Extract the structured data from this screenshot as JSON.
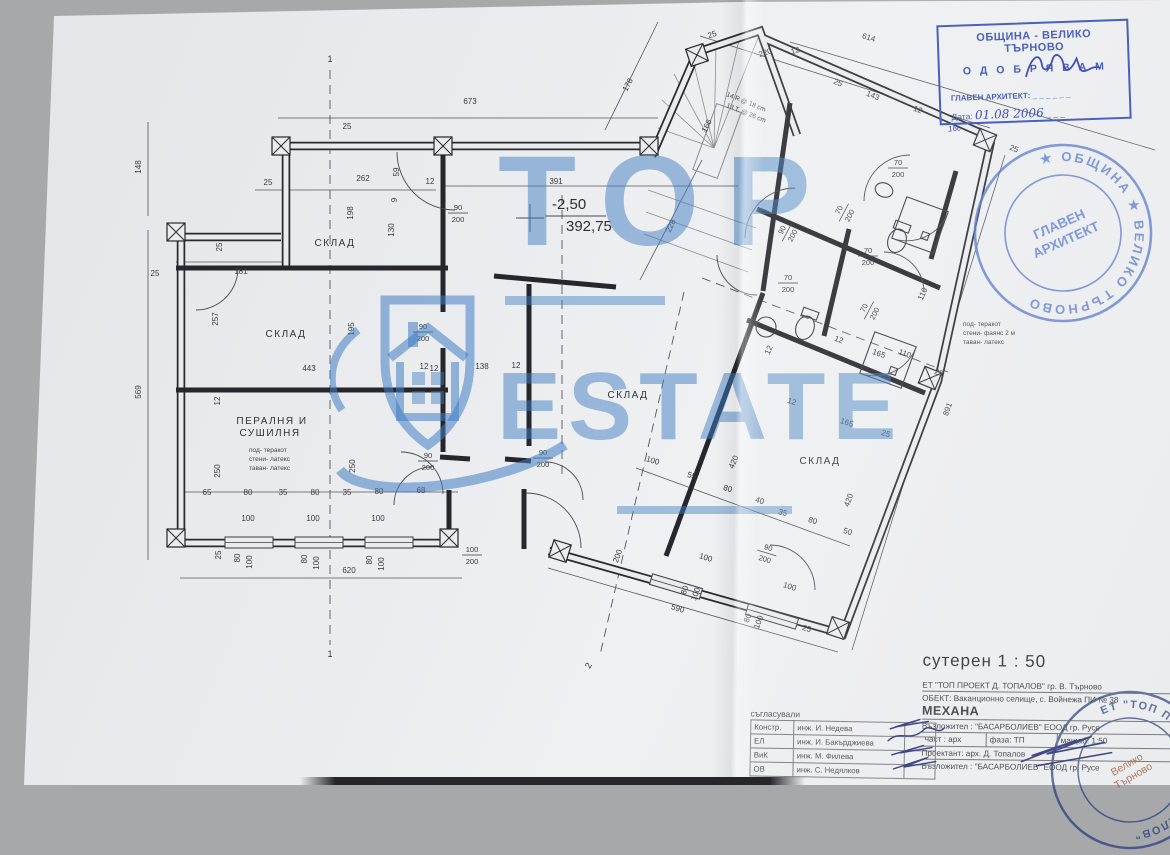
{
  "approval_stamp": {
    "line1": "ОБЩИНА - ВЕЛИКО ТЪРНОВО",
    "line2": "О Д О Б Р Я В А М",
    "architect_label": "ГЛАВЕН АРХИТЕКТ: _ _ _ _ _ _",
    "date_label": "Дата:",
    "date_value": "01.08 2006",
    "date_dashes": "_ _ _",
    "note_below": "16с",
    "color": "#3550b4"
  },
  "round_stamp_top": {
    "ring_text": "★ ОБЩИНА ★ ВЕЛИКО ТЪРНОВО",
    "center_line1": "ГЛАВЕН",
    "center_line2": "АРХИТЕКТ"
  },
  "round_stamp_bottom": {
    "ring_text": "ЕТ \"ТОП ПРОЕКТ - Д. ТОПАЛОВ\"",
    "center_line1": "Велико",
    "center_line2": "Търново"
  },
  "watermark": {
    "word1": "TOP",
    "word2": "ESTATE"
  },
  "plan": {
    "scale_title": "сутерен 1 : 50",
    "level_mark": {
      "elevation": "-2,50",
      "absolute": "392,75"
    },
    "rooms": [
      {
        "t": "СКЛАД",
        "x": 335,
        "y": 246
      },
      {
        "t": "СКЛАД",
        "x": 286,
        "y": 337
      },
      {
        "t": "СКЛАД",
        "x": 628,
        "y": 398
      },
      {
        "t": "СКЛАД",
        "x": 820,
        "y": 464
      }
    ],
    "laundry": {
      "line1": "ПЕРАЛНЯ И",
      "line2": "СУШИЛНЯ",
      "notes": [
        "под- теракот",
        "стени- латекс",
        "таван- латекс"
      ]
    },
    "finish_note_right": [
      "под- теракот",
      "стени- фаянс 2 м",
      "таван- латекс"
    ],
    "stair_note": [
      "14 R @ 18 cm",
      "13 T. @ 26 cm"
    ],
    "section_markers": [
      {
        "t": "1",
        "x": 330,
        "y": 62,
        "r": 0
      },
      {
        "t": "1",
        "x": 330,
        "y": 657,
        "r": 0
      },
      {
        "t": "2",
        "x": 591,
        "y": 667,
        "r": -60
      }
    ],
    "dimensions": [
      [
        "673",
        470,
        104,
        0
      ],
      [
        "148",
        141,
        167,
        -90
      ],
      [
        "569",
        141,
        392,
        -90
      ],
      [
        "25",
        347,
        129,
        0
      ],
      [
        "25",
        268,
        185,
        0
      ],
      [
        "262",
        363,
        181,
        0
      ],
      [
        "12",
        430,
        184,
        0
      ],
      [
        "198",
        353,
        213,
        -90
      ],
      [
        "59",
        399,
        172,
        -90
      ],
      [
        "9",
        397,
        200,
        -90
      ],
      [
        "130",
        394,
        230,
        -90
      ],
      [
        "181",
        241,
        274,
        0
      ],
      [
        "25",
        155,
        276,
        0
      ],
      [
        "25",
        222,
        247,
        -90
      ],
      [
        "257",
        218,
        319,
        -90
      ],
      [
        "195",
        354,
        329,
        -90
      ],
      [
        "443",
        309,
        371,
        0
      ],
      [
        "12",
        434,
        371,
        0
      ],
      [
        "138",
        482,
        369,
        0
      ],
      [
        "12",
        424,
        369,
        0
      ],
      [
        "12",
        516,
        368,
        0
      ],
      [
        "12",
        220,
        401,
        -90
      ],
      [
        "250",
        220,
        471,
        -90
      ],
      [
        "250",
        355,
        466,
        -90
      ],
      [
        "65",
        207,
        495,
        0
      ],
      [
        "80",
        248,
        495,
        0
      ],
      [
        "35",
        283,
        495,
        0
      ],
      [
        "80",
        315,
        495,
        0
      ],
      [
        "35",
        347,
        495,
        0
      ],
      [
        "80",
        379,
        494,
        0
      ],
      [
        "68",
        421,
        493,
        0
      ],
      [
        "100",
        248,
        521,
        0
      ],
      [
        "100",
        313,
        521,
        0
      ],
      [
        "100",
        378,
        521,
        0
      ],
      [
        "25",
        221,
        555,
        -90
      ],
      [
        "80",
        240,
        558,
        -90
      ],
      [
        "100",
        252,
        562,
        -90
      ],
      [
        "80",
        307,
        559,
        -90
      ],
      [
        "100",
        319,
        563,
        -90
      ],
      [
        "80",
        372,
        560,
        -90
      ],
      [
        "100",
        384,
        564,
        -90
      ],
      [
        "620",
        349,
        573,
        0
      ],
      [
        "391",
        556,
        184,
        0
      ],
      [
        "178",
        630,
        86,
        -62
      ],
      [
        "25",
        713,
        37,
        -18
      ],
      [
        "220",
        766,
        55,
        -18
      ],
      [
        "12",
        796,
        53,
        -18
      ],
      [
        "614",
        868,
        40,
        16
      ],
      [
        "25",
        837,
        85,
        22
      ],
      [
        "143",
        872,
        98,
        22
      ],
      [
        "12",
        917,
        112,
        22
      ],
      [
        "166",
        709,
        127,
        -64
      ],
      [
        "228",
        673,
        227,
        -64
      ],
      [
        "25",
        1013,
        151,
        22
      ],
      [
        "110",
        925,
        295,
        -66
      ],
      [
        "12",
        771,
        351,
        -66
      ],
      [
        "165",
        878,
        356,
        20
      ],
      [
        "110",
        904,
        356,
        20
      ],
      [
        "12",
        838,
        342,
        20
      ],
      [
        "25",
        938,
        375,
        20
      ],
      [
        "891",
        950,
        410,
        -70
      ],
      [
        "165",
        846,
        425,
        18
      ],
      [
        "25",
        885,
        436,
        18
      ],
      [
        "12",
        791,
        404,
        18
      ],
      [
        "420",
        851,
        501,
        -70
      ],
      [
        "420",
        736,
        463,
        -66
      ],
      [
        "100",
        652,
        463,
        17
      ],
      [
        "55",
        691,
        478,
        17
      ],
      [
        "80",
        727,
        491,
        17
      ],
      [
        "40",
        759,
        503,
        17
      ],
      [
        "35",
        782,
        515,
        17
      ],
      [
        "80",
        812,
        523,
        17
      ],
      [
        "50",
        847,
        534,
        17
      ],
      [
        "100",
        705,
        560,
        17
      ],
      [
        "100",
        789,
        589,
        17
      ],
      [
        "590",
        677,
        611,
        17
      ],
      [
        "80",
        687,
        591,
        -70
      ],
      [
        "100",
        698,
        595,
        -70
      ],
      [
        "80",
        750,
        619,
        -70
      ],
      [
        "100",
        761,
        623,
        -70
      ],
      [
        "25",
        806,
        631,
        17
      ],
      [
        "200",
        620,
        557,
        -70
      ]
    ],
    "door_labels": [
      [
        "90",
        "200",
        458,
        212,
        0
      ],
      [
        "90",
        "200",
        423,
        331,
        0
      ],
      [
        "90",
        "200",
        428,
        460,
        0
      ],
      [
        "90",
        "200",
        543,
        457,
        0
      ],
      [
        "100",
        "200",
        472,
        554,
        0
      ],
      [
        "90",
        "200",
        767,
        552,
        17
      ],
      [
        "90",
        "200",
        786,
        232,
        -62
      ],
      [
        "70",
        "200",
        843,
        212,
        -62
      ],
      [
        "70",
        "200",
        898,
        167,
        0
      ],
      [
        "70",
        "200",
        868,
        255,
        0
      ],
      [
        "70",
        "200",
        788,
        282,
        0
      ],
      [
        "70",
        "200",
        868,
        310,
        -62
      ]
    ]
  },
  "title_block": {
    "company": "ЕТ \"ТОП ПРОЕКТ Д. ТОПАЛОВ\" гр. В. Търново",
    "object_line": "ОБЕКТ: Ваканционно селище, с. Войнежа ПИ № 38",
    "object_name": "МЕХАНА",
    "client": "Възложител : \"БАСАРБОЛИЕВ\" ЕООД   гр. Русе",
    "part": "част : арх",
    "phase": "фаза: ТП",
    "scale": "мащаб: 1:50",
    "designer": "Проектант:   арх. Д. Топалов",
    "client2": "Възложител : \"БАСАРБОЛИЕВ\" ЕООД   гр. Русе"
  },
  "signature_table": {
    "header": "съгласували",
    "rows": [
      [
        "Констр.",
        "инж. И. Недева"
      ],
      [
        "ЕЛ",
        "инж. И. Бакърджиева"
      ],
      [
        "ВиК",
        "инж. М. Филева"
      ],
      [
        "ОВ",
        "инж. С. Недялков"
      ]
    ]
  }
}
